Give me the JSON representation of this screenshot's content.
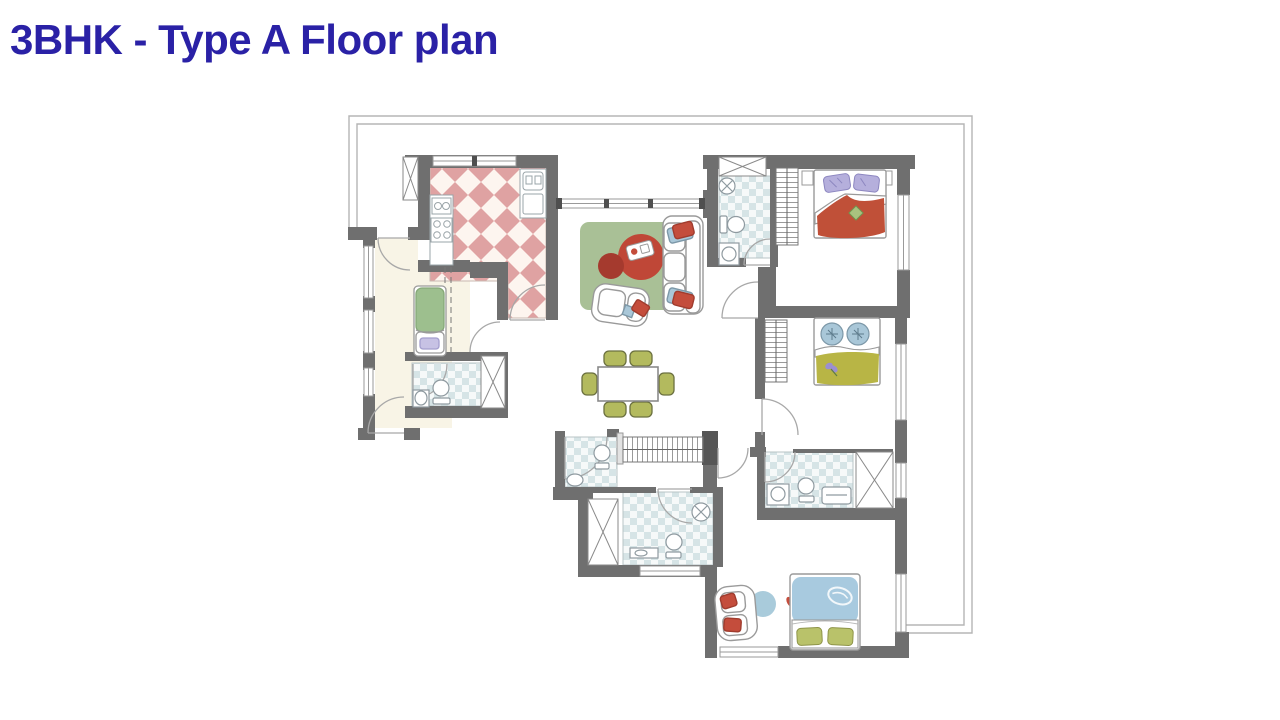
{
  "page": {
    "title": "3BHK - Type A Floor plan",
    "title_color": "#2a21a6",
    "background": "#ffffff"
  },
  "floorplan": {
    "colors": {
      "wall": "#6f6f6f",
      "wall_dark": "#565656",
      "outline": "#b5b5b5",
      "window_stroke": "#9a9a9a",
      "kitchen_tile": "#dfa2a2",
      "kitchen_tile_bg": "#fdf5ef",
      "bath_tile": "#d6e4e6",
      "bath_tile_bg": "#f6f9f9",
      "foyer_floor": "#f8f4e6",
      "rug_green": "#a9c096",
      "table_red": "#bf4737",
      "table_red_dark": "#a53a2e",
      "accent_red": "#c44d3c",
      "chair_olive": "#b3ba5e",
      "bed1_blanket": "#c05038",
      "pillow_lavender": "#b5afdc",
      "bed2_blanket": "#b8b545",
      "pillow_blue": "#a9c7d8",
      "bed3_blanket": "#a8cadf",
      "pillow_olive": "#b9c26a",
      "daybed_green": "#9dbf8e",
      "blue_rug": "#a9cbdb",
      "fixture_stroke": "#8f9aa0",
      "door_arc": "#a8a8a8",
      "furniture_stroke": "#9a9a9a"
    },
    "rooms": [
      "terrace",
      "kitchen",
      "foyer-maid-room",
      "maid-bathroom",
      "living-room",
      "dining-area",
      "powder-room",
      "corridor",
      "master-bathroom",
      "master-bedroom",
      "bedroom-1",
      "ensuite-bathroom",
      "bedroom-2",
      "shared-bathroom"
    ],
    "furniture": [
      "sofa",
      "armchair",
      "coffee-table",
      "area-rug",
      "dining-table",
      "dining-chairs",
      "double-bed",
      "wardrobe",
      "daybed",
      "toilet",
      "sink",
      "shower",
      "vanity",
      "shaft"
    ]
  }
}
